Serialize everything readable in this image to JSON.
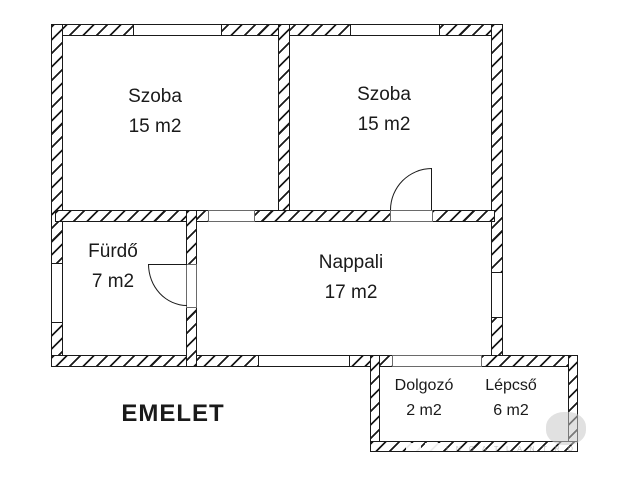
{
  "plan_title": "EMELET",
  "rooms": [
    {
      "id": "szoba-1",
      "name": "Szoba",
      "area": "15 m2"
    },
    {
      "id": "szoba-2",
      "name": "Szoba",
      "area": "15 m2"
    },
    {
      "id": "furdo",
      "name": "Fürdő",
      "area": "7 m2"
    },
    {
      "id": "nappali",
      "name": "Nappali",
      "area": "17 m2"
    },
    {
      "id": "dolgozo",
      "name": "Dolgozó",
      "area": "2 m2"
    },
    {
      "id": "lepcso",
      "name": "Lépcső",
      "area": "6 m2"
    }
  ],
  "watermark_text": "I N G A T L A N T R O",
  "colors": {
    "line": "#1a1a1a",
    "background": "#ffffff",
    "watermark": "#9a9a9a"
  }
}
